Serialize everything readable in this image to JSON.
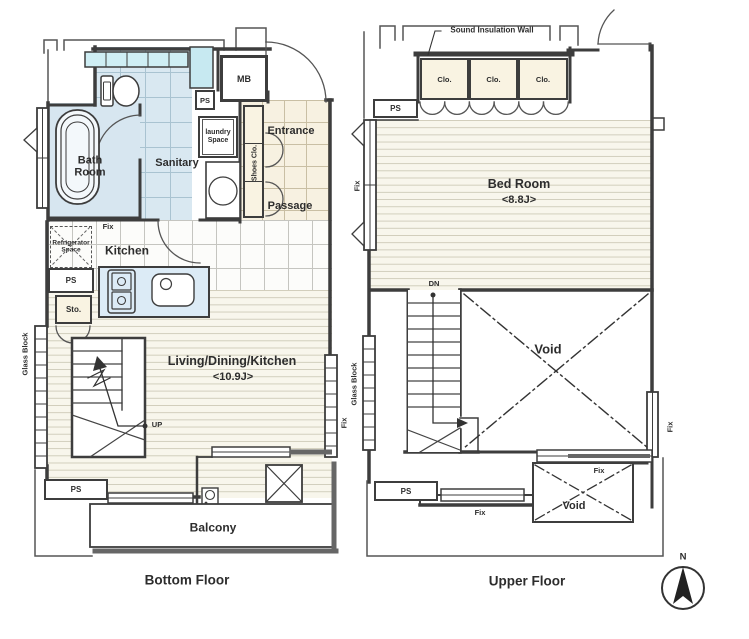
{
  "bottom_floor": {
    "title": "Bottom Floor",
    "labels": {
      "mb": "MB",
      "ps_top": "PS",
      "laundry": "laundry Space",
      "bath": "Bath Room",
      "sanitary": "Sanitary",
      "entrance": "Entrance",
      "shoes_clo": "Shoes Clo.",
      "passage": "Passage",
      "refrigerator": "Refrigerator Space",
      "fix_kitchen": "Fix",
      "kitchen": "Kitchen",
      "ps_mid": "PS",
      "sto": "Sto.",
      "ldk": "Living/Dining/Kitchen",
      "ldk_size": "<10.9J>",
      "up": "UP",
      "glass_block": "Glass Block",
      "fix_window": "Fix",
      "ps_bottom": "PS",
      "balcony": "Balcony"
    }
  },
  "upper_floor": {
    "title": "Upper Floor",
    "labels": {
      "sound_insulation_wall": "Sound Insulation Wall",
      "closet_1": "Clo.",
      "closet_2": "Clo.",
      "closet_3": "Clo.",
      "ps_top": "PS",
      "bedroom": "Bed Room",
      "bedroom_size": "<8.8J>",
      "fix_left": "Fix",
      "glass_block": "Glass Block",
      "dn": "DN",
      "void_upper": "Void",
      "fix_right": "Fix",
      "ps_bottom": "PS",
      "fix_bottom": "Fix",
      "fix_lower": "Fix",
      "void_lower": "Void"
    }
  },
  "compass": {
    "north": "N"
  },
  "colors": {
    "wall": "#3d3d3d",
    "tile_blue": "#d9e8f1",
    "tile_cream": "#f7f1e1",
    "plank": "#f8f6ec",
    "window_cyan": "#c7e9f1",
    "counter_blue": "#dcebf6"
  }
}
